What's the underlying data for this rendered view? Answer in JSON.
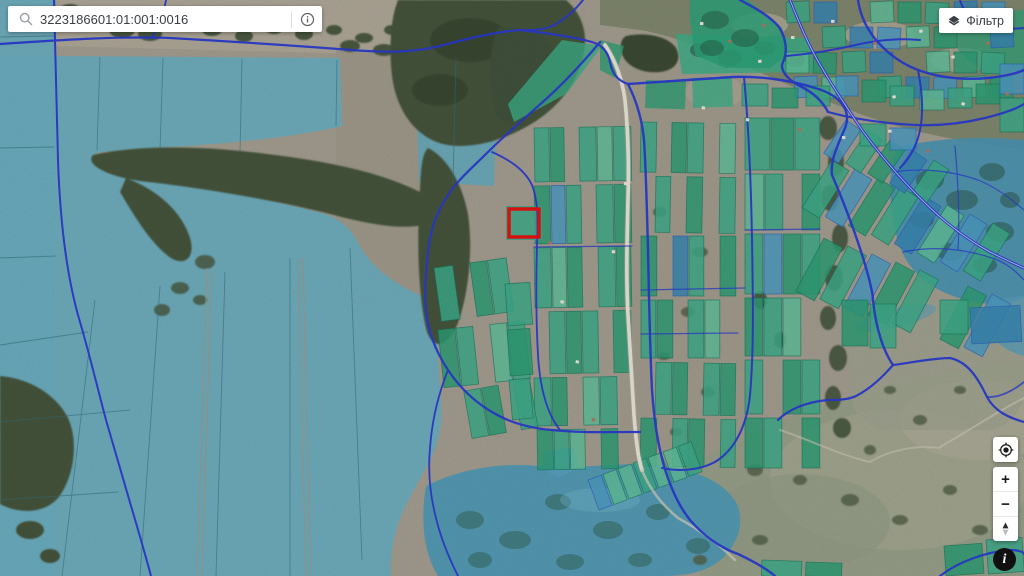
{
  "search_bar": {
    "value": "3223186601:01:001:0016"
  },
  "filter_button": {
    "label": "Фільтр"
  },
  "zoom_controls": {
    "zoom_in_label": "+",
    "zoom_out_label": "−"
  },
  "attribution_button": {
    "label": "i"
  },
  "map": {
    "selected_parcel_outline_color": "#e81313",
    "overlay_colors": {
      "field_blue": "#6db1c3",
      "parcel_green": "#3fae8c",
      "parcel_green_dark": "#2fa077",
      "parcel_green_pale": "#63c29e",
      "parcel_blue": "#4f9dc4",
      "parcel_blue_dark": "#3a88b5",
      "road_blue": "#2b3cd4"
    }
  }
}
